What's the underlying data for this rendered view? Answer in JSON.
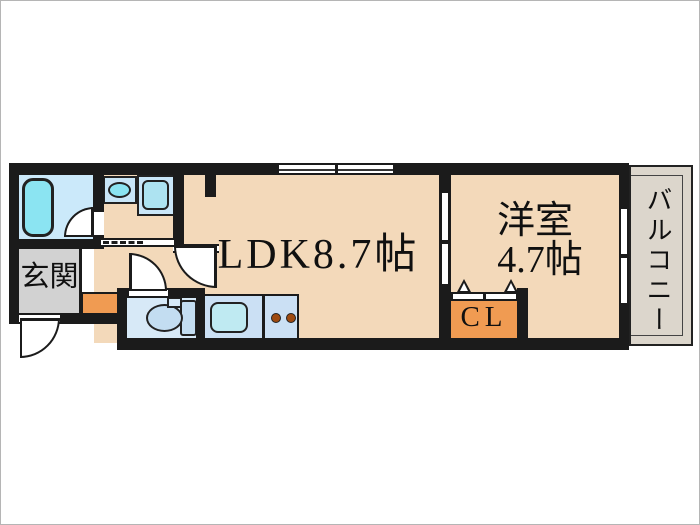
{
  "labels": {
    "ldk": "LDK8.7帖",
    "bedroom_name": "洋室",
    "bedroom_size": "4.7帖",
    "entrance": "玄関",
    "closet": "CL",
    "balcony": "バルコニー"
  },
  "colors": {
    "wall": "#1b1b1b",
    "floor": "#F3D9BA",
    "entrance_floor": "#D2D2D2",
    "balcony_floor": "#DCD6CC",
    "accent": "#F09B52",
    "bath_floor": "#CBE9FA",
    "fixture": "#8BE4F2",
    "fixture_block": "#C9E6F8",
    "washer_drum": "#ADE3F1",
    "toilet_floor": "#D7E9F7",
    "toilet_bowl": "#C3DDF1",
    "kitchen_counter": "#CBE0F4",
    "kitchen_sink": "#BFEAF2",
    "burner": "#9E4A10"
  }
}
